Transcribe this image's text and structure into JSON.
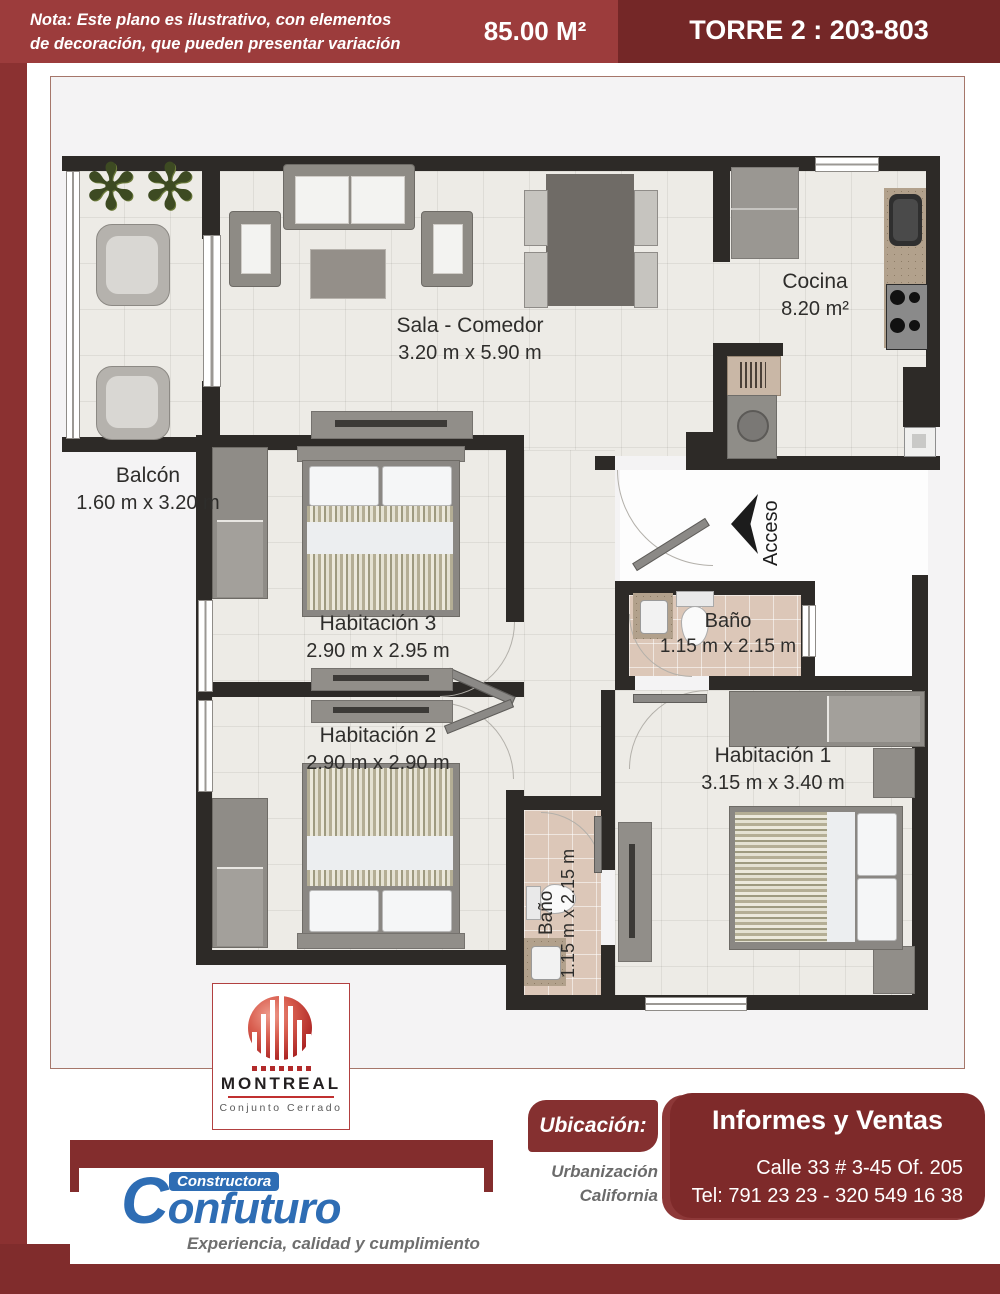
{
  "header": {
    "note_line1": "Nota: Este plano es ilustrativo, con elementos",
    "note_line2": "de decoración, que pueden presentar variación",
    "area": "85.00 M²",
    "tower": "TORRE 2 : 203-803"
  },
  "plan": {
    "rooms": {
      "balcon": {
        "name": "Balcón",
        "dims": "1.60 m x 3.20 m"
      },
      "sala": {
        "name": "Sala - Comedor",
        "dims": "3.20 m x 5.90 m"
      },
      "cocina": {
        "name": "Cocina",
        "dims": "8.20 m²"
      },
      "hab3": {
        "name": "Habitación 3",
        "dims": "2.90 m x 2.95 m"
      },
      "hab2": {
        "name": "Habitación 2",
        "dims": "2.90 m x 2.90 m"
      },
      "hab1": {
        "name": "Habitación 1",
        "dims": "3.15 m x 3.40 m"
      },
      "bano1": {
        "name": "Baño",
        "dims": "1.15 m x 2.15 m"
      },
      "bano2": {
        "name": "Baño",
        "dims": "1.15 m x 2.15 m"
      }
    },
    "access_label": "Acceso",
    "palm_icon": "✻"
  },
  "montreal": {
    "name": "MONTREAL",
    "subtitle": "Conjunto  Cerrado"
  },
  "confuturo": {
    "pre": "Constructora",
    "name": "Confuturo",
    "tagline": "Experiencia, calidad y cumplimiento"
  },
  "contact": {
    "ubicacion_label": "Ubicación:",
    "ubicacion_line1": "Urbanización",
    "ubicacion_line2": "California",
    "title": "Informes y Ventas",
    "address": "Calle 33 # 3-45 Of. 205",
    "phone": "Tel: 791 23 23 - 320 549 16 38"
  },
  "colors": {
    "header_left": "#9c3c3c",
    "header_right": "#742727",
    "maroon": "#832d2d",
    "wall": "#2d2a27",
    "floor": "#edebe6",
    "bath_floor": "#dcc7b8",
    "confuturo_blue": "#2e6db4",
    "montreal_red": "#b22a2a"
  }
}
